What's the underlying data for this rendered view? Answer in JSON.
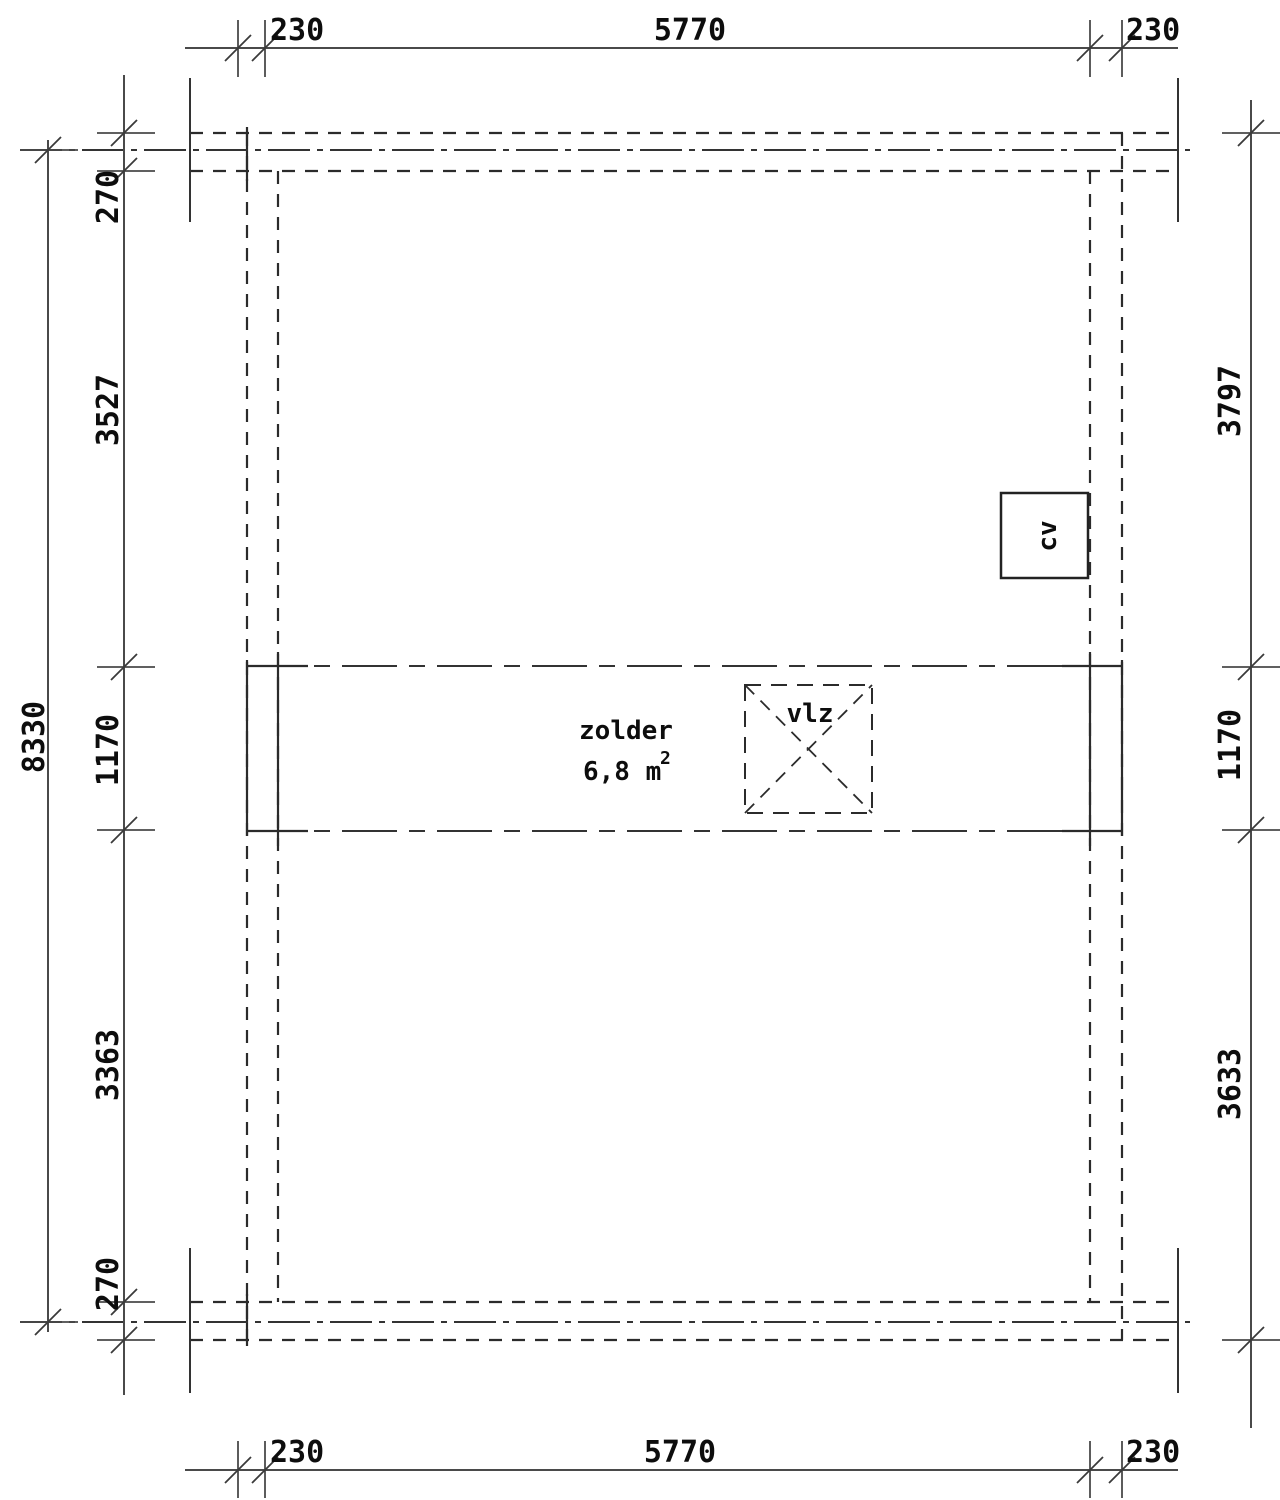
{
  "drawing": {
    "labels": {
      "room_name": "zolder",
      "room_area": "6,8 m",
      "room_area_sup": "2",
      "hatch": "vlz",
      "boiler": "cv"
    },
    "dimensions": {
      "top": [
        "230",
        "5770",
        "230"
      ],
      "bottom": [
        "230",
        "5770",
        "230"
      ],
      "left": [
        "270",
        "3527",
        "1170",
        "3363",
        "270"
      ],
      "left_total": "8330",
      "right": [
        "3797",
        "1170",
        "3633"
      ]
    },
    "colors": {
      "line": "#2b2b2b",
      "dimension_line": "#4a4a4a",
      "text": "#0d0d0d",
      "background": "#ffffff"
    }
  }
}
